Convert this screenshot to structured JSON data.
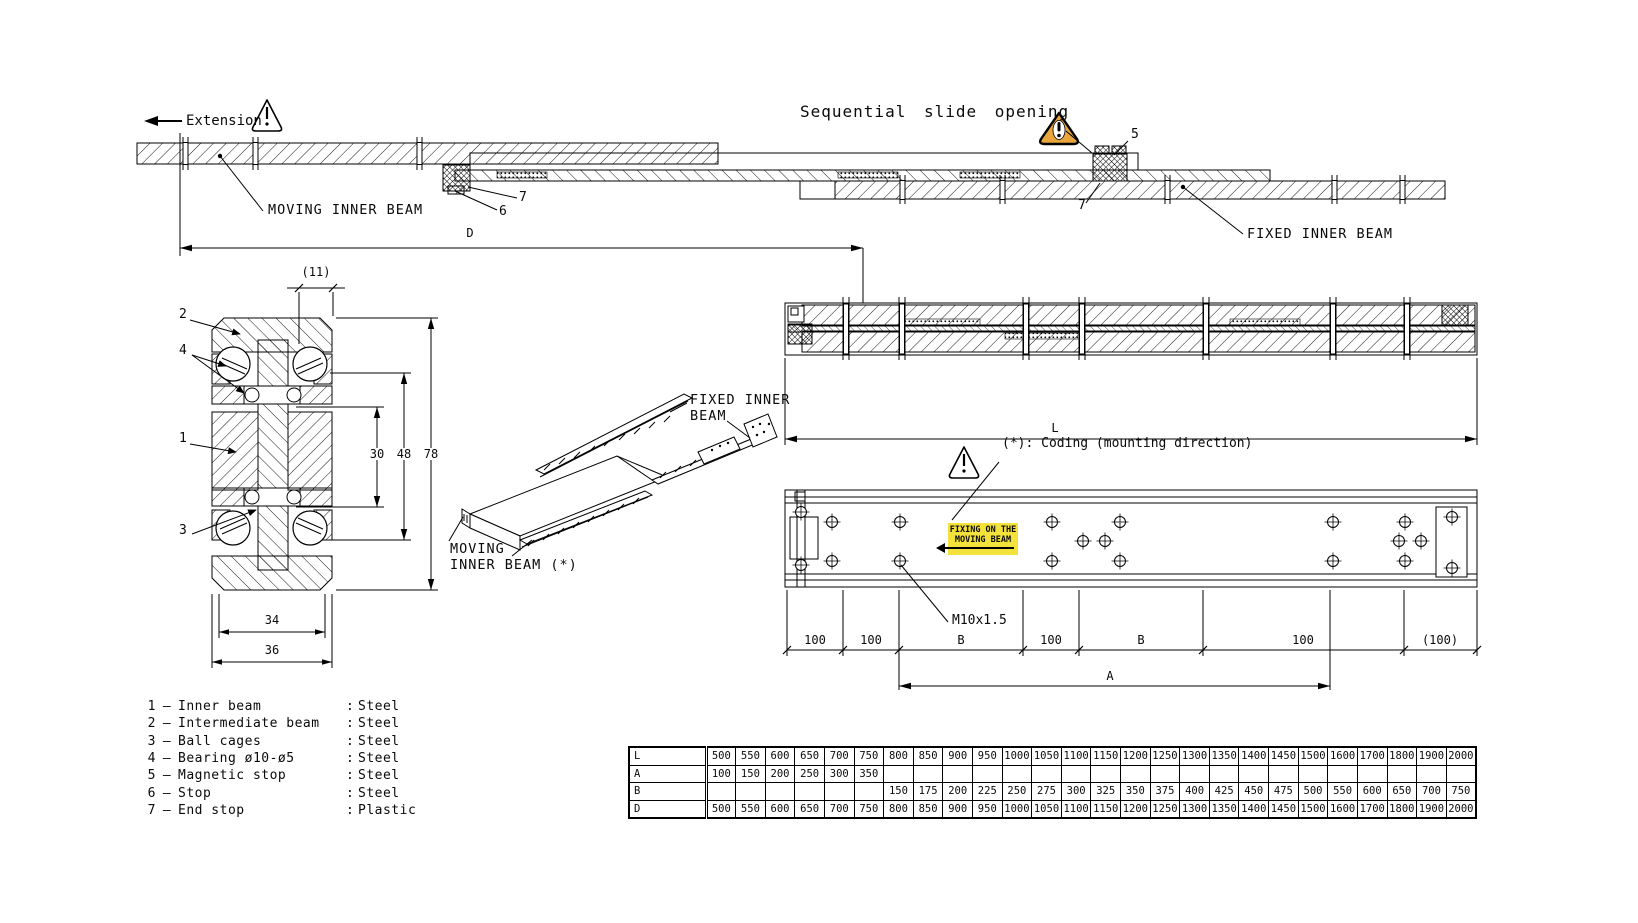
{
  "title": "Telescopic slide technical drawing",
  "colors": {
    "warning_amber": "#E8A53C",
    "highlight_yellow": "#F3E23B",
    "line_black": "#0a0a0a"
  },
  "annotations": {
    "extension": "Extension",
    "sequential": "Sequential slide opening",
    "moving_inner_beam": "MOVING INNER BEAM",
    "fixed_inner_beam": "FIXED INNER BEAM",
    "iso_fixed_1": "FIXED INNER",
    "iso_fixed_2": "BEAM",
    "iso_moving_1": "MOVING",
    "iso_moving_2": "INNER BEAM (*)",
    "coding_note": "(*): Coding (mounting direction)",
    "fixing_1": "FIXING ON THE",
    "fixing_2": "MOVING BEAM",
    "thread": "M10x1.5"
  },
  "callouts": {
    "c1": "1",
    "c2": "2",
    "c3": "3",
    "c4": "4",
    "c5": "5",
    "c6": "6",
    "c7a": "7",
    "c7b": "7"
  },
  "dims": {
    "d": "D",
    "l": "L",
    "a": "A",
    "w11": "(11)",
    "h30": "30",
    "h48": "48",
    "h78": "78",
    "w34": "34",
    "w36": "36",
    "segments": [
      "100",
      "100",
      "B",
      "100",
      "B",
      "100",
      "(100)"
    ]
  },
  "parts_list": {
    "separator": "–",
    "colon": ":",
    "items": [
      {
        "num": "1",
        "name": "Inner beam",
        "material": "Steel"
      },
      {
        "num": "2",
        "name": "Intermediate beam",
        "material": "Steel"
      },
      {
        "num": "3",
        "name": "Ball cages",
        "material": "Steel"
      },
      {
        "num": "4",
        "name": "Bearing ø10-ø5",
        "material": "Steel"
      },
      {
        "num": "5",
        "name": "Magnetic stop",
        "material": "Steel"
      },
      {
        "num": "6",
        "name": "Stop",
        "material": "Steel"
      },
      {
        "num": "7",
        "name": "End stop",
        "material": "Plastic"
      }
    ]
  },
  "size_table": {
    "rows": [
      {
        "header": "L",
        "values": [
          "500",
          "550",
          "600",
          "650",
          "700",
          "750",
          "800",
          "850",
          "900",
          "950",
          "1000",
          "1050",
          "1100",
          "1150",
          "1200",
          "1250",
          "1300",
          "1350",
          "1400",
          "1450",
          "1500",
          "1600",
          "1700",
          "1800",
          "1900",
          "2000"
        ]
      },
      {
        "header": "A",
        "values": [
          "100",
          "150",
          "200",
          "250",
          "300",
          "350",
          "",
          "",
          "",
          "",
          "",
          "",
          "",
          "",
          "",
          "",
          "",
          "",
          "",
          "",
          "",
          "",
          "",
          "",
          "",
          ""
        ]
      },
      {
        "header": "B",
        "values": [
          "",
          "",
          "",
          "",
          "",
          "",
          "150",
          "175",
          "200",
          "225",
          "250",
          "275",
          "300",
          "325",
          "350",
          "375",
          "400",
          "425",
          "450",
          "475",
          "500",
          "550",
          "600",
          "650",
          "700",
          "750"
        ]
      },
      {
        "header": "D",
        "values": [
          "500",
          "550",
          "600",
          "650",
          "700",
          "750",
          "800",
          "850",
          "900",
          "950",
          "1000",
          "1050",
          "1100",
          "1150",
          "1200",
          "1250",
          "1300",
          "1350",
          "1400",
          "1450",
          "1500",
          "1600",
          "1700",
          "1800",
          "1900",
          "2000"
        ]
      }
    ]
  }
}
